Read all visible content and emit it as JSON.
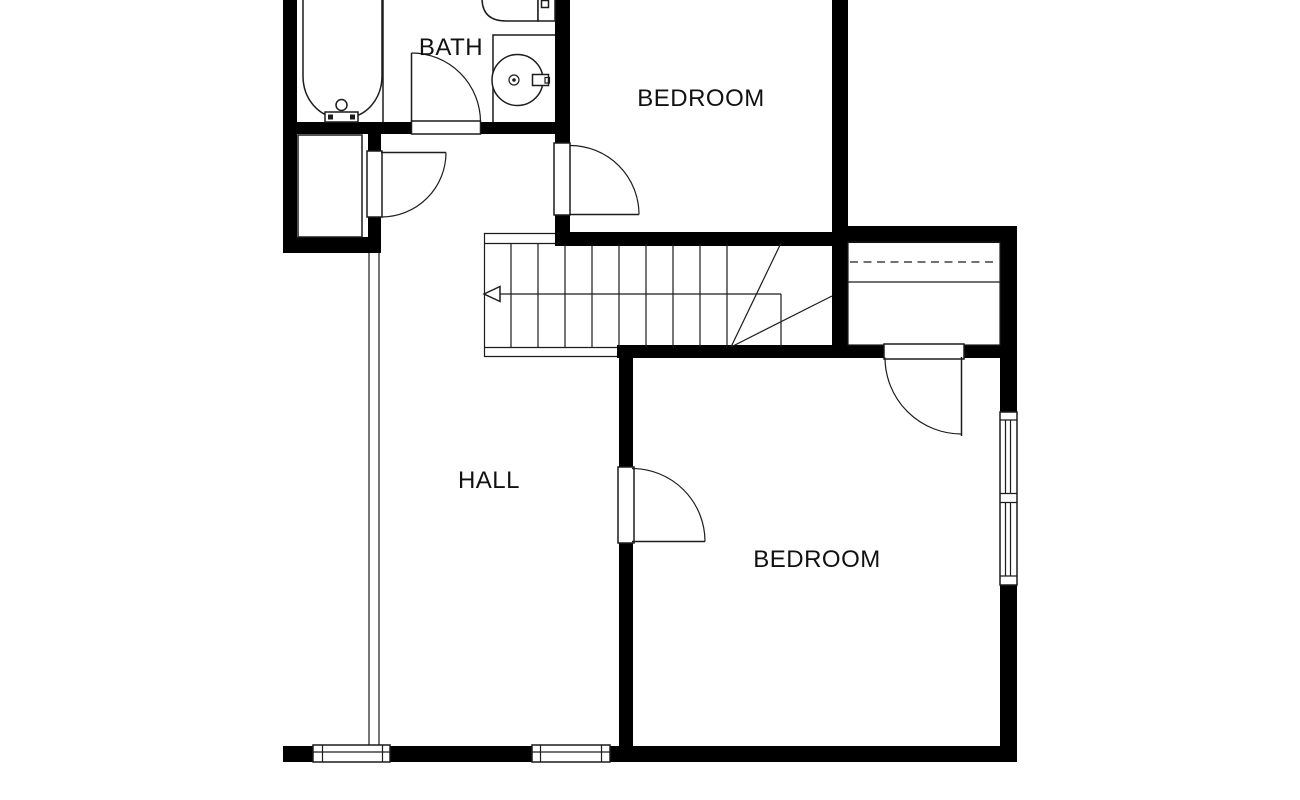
{
  "floorplan": {
    "labels": {
      "bath": "BATH",
      "bedroom_top": "BEDROOM",
      "hall": "HALL",
      "bedroom_bottom": "BEDROOM"
    },
    "colors": {
      "wall": "#000000",
      "line": "#1c1c1c",
      "background": "#ffffff",
      "text": "#111111"
    }
  }
}
